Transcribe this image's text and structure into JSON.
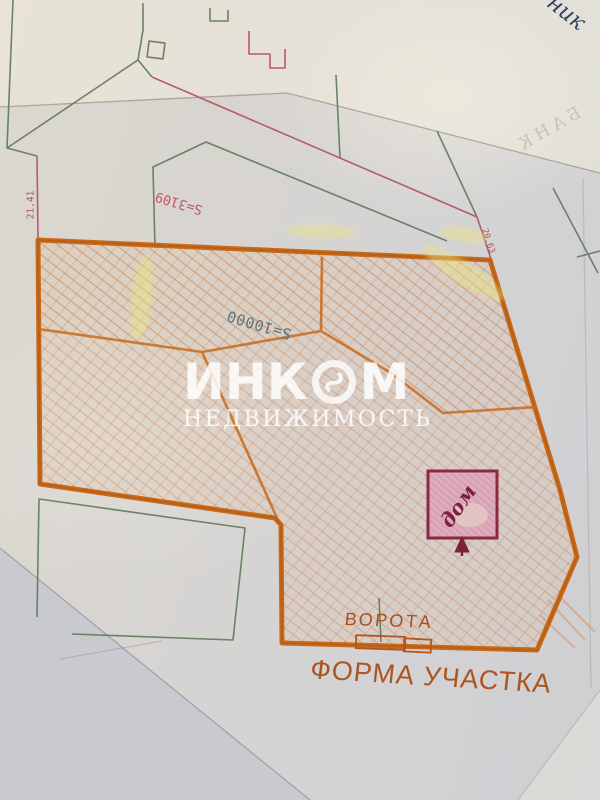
{
  "watermark": {
    "brand_left": "ИНК",
    "brand_right": "М",
    "subtitle": "НЕДВИЖИМОСТЬ"
  },
  "plot": {
    "area_label": "S=10000",
    "neighbor_area_label": "S=3109",
    "left_dimension": "21.41",
    "right_dimension": "20.63",
    "house_label": "дом",
    "gate_label": "ВОРОТА",
    "caption": "ФОРМА УЧАСТКА"
  },
  "annotations": {
    "corner_handwriting": "ник",
    "show_through_text": "БАНК"
  },
  "colors": {
    "marker_orange": "#c96a1b",
    "pen_green": "#5d7a57",
    "pen_red": "#b65a6d",
    "house_maroon": "#8e2743",
    "area_label_blue": "#5b7283",
    "area_label_pink": "#c4556a",
    "highlighter_yellow": "#ece47e",
    "watermark_white": "#ffffff"
  }
}
